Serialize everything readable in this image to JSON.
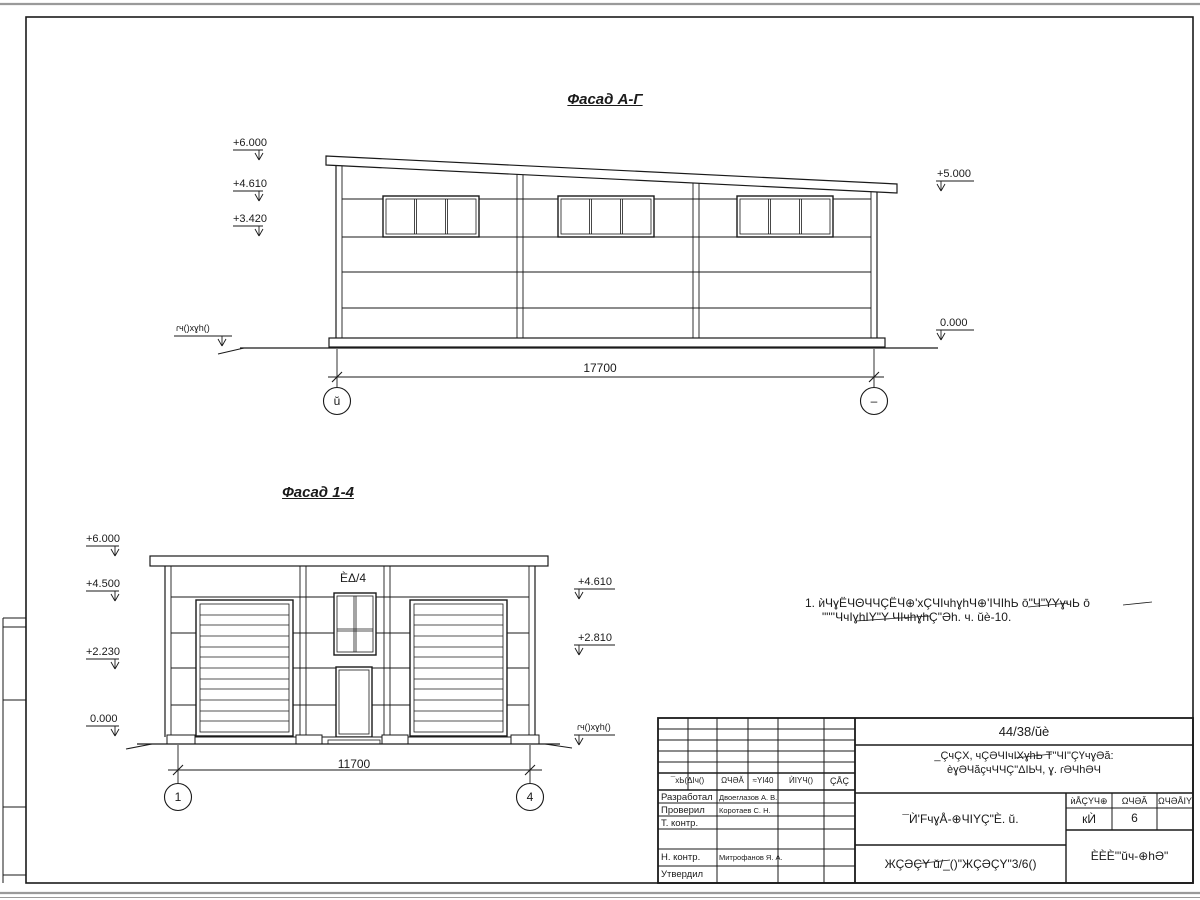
{
  "facade_ag": {
    "title": "Фасад А-Г",
    "dimension": "17700",
    "axis_left": "ŭ",
    "axis_right": "–",
    "elev_left": [
      "+6.000",
      "+4.610",
      "+3.420"
    ],
    "elev_right": [
      "+5.000",
      "0.000"
    ],
    "ground_label": "ɾч()хɣh()"
  },
  "facade_14": {
    "title": "Фасад 1-4",
    "dimension": "11700",
    "axis_left": "1",
    "axis_right": "4",
    "elev_left": [
      "+6.000",
      "+4.500",
      "+2.230",
      "0.000"
    ],
    "elev_right": [
      "+4.610",
      "+2.810"
    ],
    "ground_label": "ɾч()хɣh()",
    "window_label": "ÈΔ/4"
  },
  "note": {
    "line1": "1. ѝЧɣЁЧΘЧЧÇЁЧ⊕'хÇЧIчhɣhЧ⊕'IЧIhЬ  ō\"Ч\"ҮΥɣчЬ  ō",
    "line2": "\"\"''ЧчIɣhIΥ\"Υ  ЧIчhɣhÇ\"Əh. ч. ŭè-10."
  },
  "title_block": {
    "doc_number": "44/38/ŭè",
    "description_line1": "_ÇчÇХ, чÇƏЧIчIХɣhЬ  Т\"ЧI\"ÇҮчɣƏă:",
    "description_line2": "èɣƏЧăçчЧЧÇ\"ΔIЬЧ, ɣ. ɾƏЧhƏЧ",
    "columns": [
      "¯хЬ(ΔIч()",
      "ΩЧƏĂ",
      "≈ΥI40",
      "ЍIΥЧ()",
      "ÇÅÇ"
    ],
    "roles": [
      "Разработал",
      "Проверил",
      "Т. контр.",
      "Н. контр.",
      "Утвердил"
    ],
    "names": [
      "Двоеглазов А. В.",
      "Коротаев С. Н.",
      "Митрофанов Я. А."
    ],
    "drawing_title": "¯Ѝ'FчɣÅ-⊕ЧIΥÇ\"È. ŭ.",
    "stage_headers": [
      "ѝÅÇΥЧ⊕",
      "ΩЧƏĂ",
      "ΩЧƏÅIΥ"
    ],
    "stage": "кЍ",
    "sheet_no": "6",
    "org_code": "ЖÇƏÇΥ  ŭ/_()\"ЖÇƏÇΥ\"3/6()",
    "org_name": "ÈÈÈ'\"ŭч-⊕hƏ\""
  }
}
